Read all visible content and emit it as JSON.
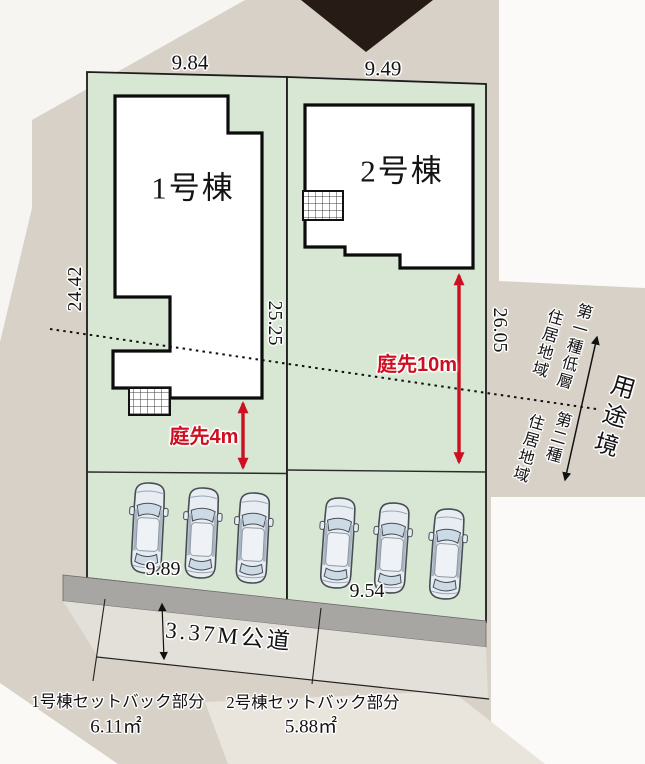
{
  "drawing": {
    "plot1": {
      "building_label": "1号棟",
      "width_top": "9.84",
      "depth_left": "24.42",
      "depth_right": "25.25",
      "width_front": "9.89",
      "garden_depth_label": "庭先4m",
      "setback_label": "1号棟セットバック部分",
      "setback_area": "6.11㎡"
    },
    "plot2": {
      "building_label": "2号棟",
      "width_top": "9.49",
      "depth_right": "26.05",
      "width_front": "9.54",
      "garden_depth_label": "庭先10m",
      "setback_label": "2号棟セットバック部分",
      "setback_area": "5.88㎡"
    },
    "road_label": "3.37M公道",
    "zoning": {
      "upper_zone_line1": "第一種低層",
      "upper_zone_line2": "住居地域",
      "lower_zone_line1": "第二種",
      "lower_zone_line2": "住居地域",
      "boundary_label": "用途境"
    },
    "colors": {
      "plot_green": "#d7e7d3",
      "background_beige": "#d8d1c7",
      "road_gray": "#a7a6a3",
      "accent_red": "#cd1021",
      "car_body": "#e7edf2",
      "line_black": "#111111"
    },
    "icons": {
      "north_triangle": "north-pointer-triangle-icon",
      "car": "parked-car-top-view-icon",
      "garden_arrows": "red-double-arrow-icon",
      "zone_arrow": "zone-boundary-double-arrow-icon"
    }
  }
}
